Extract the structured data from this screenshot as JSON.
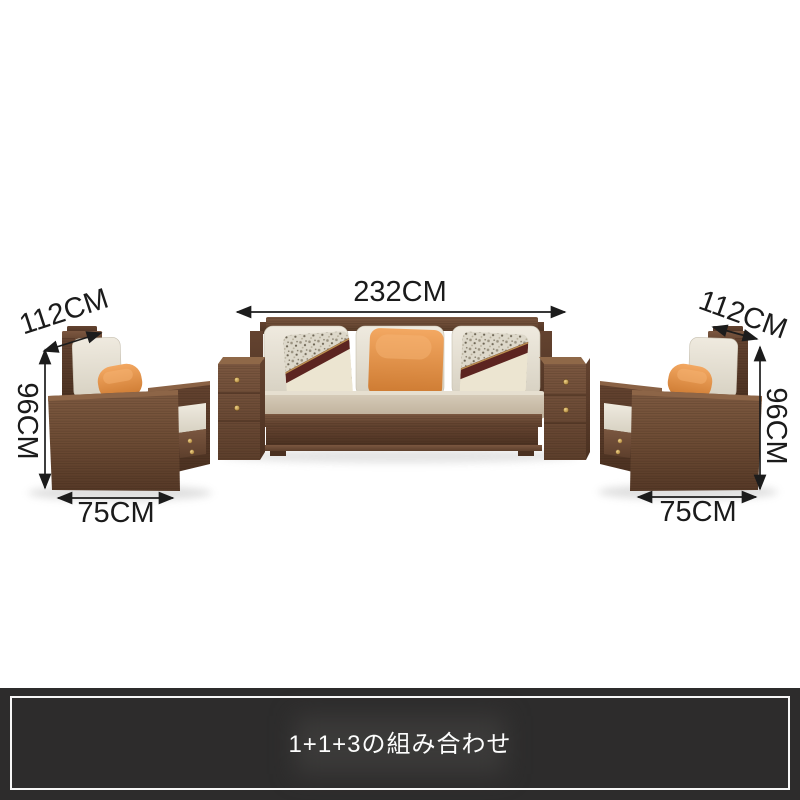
{
  "scene": {
    "description": "Wooden sofa set product dimension image: one three-seat sofa with two attached drawer side-tables, flanked by two matching armchairs",
    "items": [
      {
        "name": "armchair-left"
      },
      {
        "name": "three-seat-sofa"
      },
      {
        "name": "armchair-right"
      }
    ]
  },
  "dimensions": {
    "armchair_left": {
      "width_label": "112CM",
      "height_label": "96CM",
      "depth_label": "75CM"
    },
    "sofa": {
      "width_label": "232CM"
    },
    "armchair_right": {
      "width_label": "112CM",
      "height_label": "96CM",
      "depth_label": "75CM"
    }
  },
  "banner": {
    "caption": "1+1+3の組み合わせ"
  },
  "colors": {
    "background": "#ffffff",
    "wood_light": "#8a6448",
    "wood_mid": "#74513a",
    "wood_dark": "#5a3c29",
    "cushion_cream": "#e6e1d4",
    "seat_greige": "#cfc3b0",
    "pillow_orange": "#e08a45",
    "pillow_band_maroon": "#5c2420",
    "knob_gold": "#c9a24a",
    "dimension_text": "#1b1b1b",
    "banner_bg": "#2d2c2c",
    "banner_border": "#f7f7f7",
    "banner_text": "#fdfdfd"
  }
}
